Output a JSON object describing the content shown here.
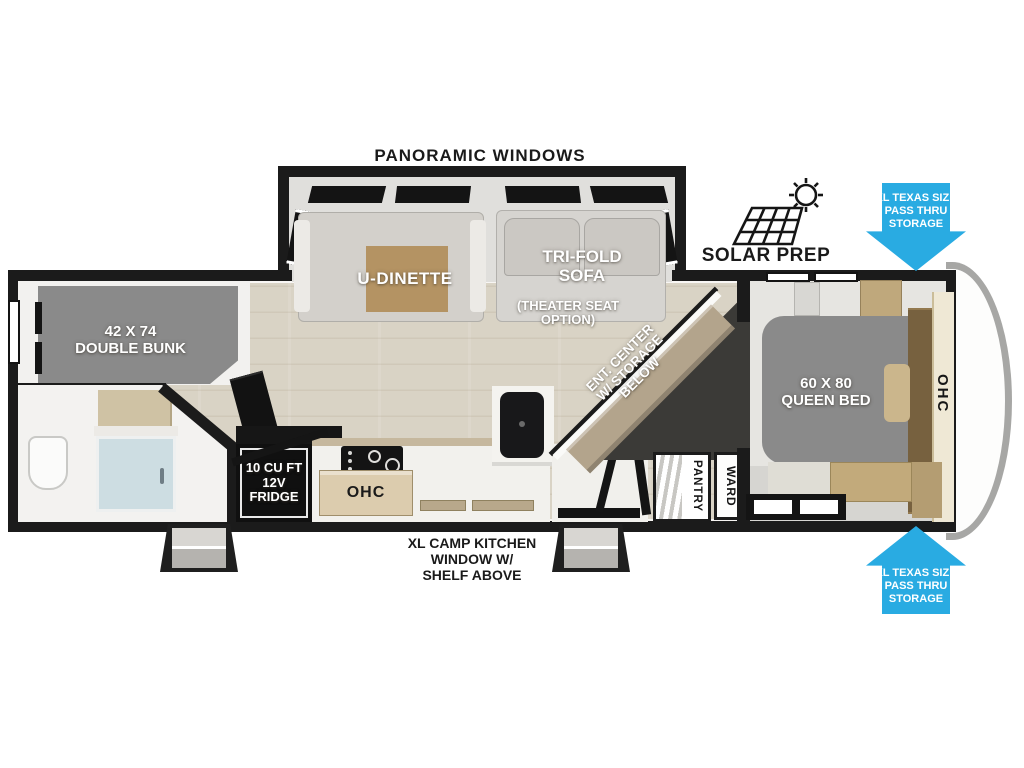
{
  "title": "Travel trailer floor plan",
  "colors": {
    "wall": "#1b1b1b",
    "floor_wood": "#d9d3c5",
    "accent_cyan": "#29abe2",
    "bed_gray": "#8a8a8a",
    "table_wood": "#b49363",
    "cabinet_tan": "#dcccae",
    "ent_cabinet_tan": "#b3a48c",
    "ohc_cream": "#efe8d5",
    "shower_glass": "#cddde2",
    "bench_wood": "#c2aa7b"
  },
  "labels": {
    "panoramic_windows": "PANORAMIC WINDOWS",
    "solar_prep": "SOLAR PREP",
    "pass_thru": [
      "XL TEXAS SIZE",
      "PASS THRU",
      "STORAGE"
    ],
    "u_dinette": "U-DINETTE",
    "tri_fold": [
      "TRI-FOLD",
      "SOFA"
    ],
    "theater": [
      "(THEATER SEAT",
      "OPTION)"
    ],
    "ent_center": [
      "ENT. CENTER",
      "W/ STORAGE",
      "BELOW"
    ],
    "queen_bed": [
      "60 X 80",
      "QUEEN BED"
    ],
    "double_bunk": [
      "42 X 74",
      "DOUBLE BUNK"
    ],
    "fridge": [
      "10 CU FT",
      "12V",
      "FRIDGE"
    ],
    "ohc_kitchen": "OHC",
    "ohc_bedroom": "OHC",
    "pantry": "PANTRY",
    "ward": "WARD",
    "camp_kitchen": [
      "XL CAMP KITCHEN",
      "WINDOW W/",
      "SHELF ABOVE"
    ]
  },
  "icons": {
    "solar_panel": "solar-panel-icon",
    "sun": "sun-icon",
    "arrow_down": "pass-thru-arrow-down",
    "arrow_up": "pass-thru-arrow-up"
  }
}
